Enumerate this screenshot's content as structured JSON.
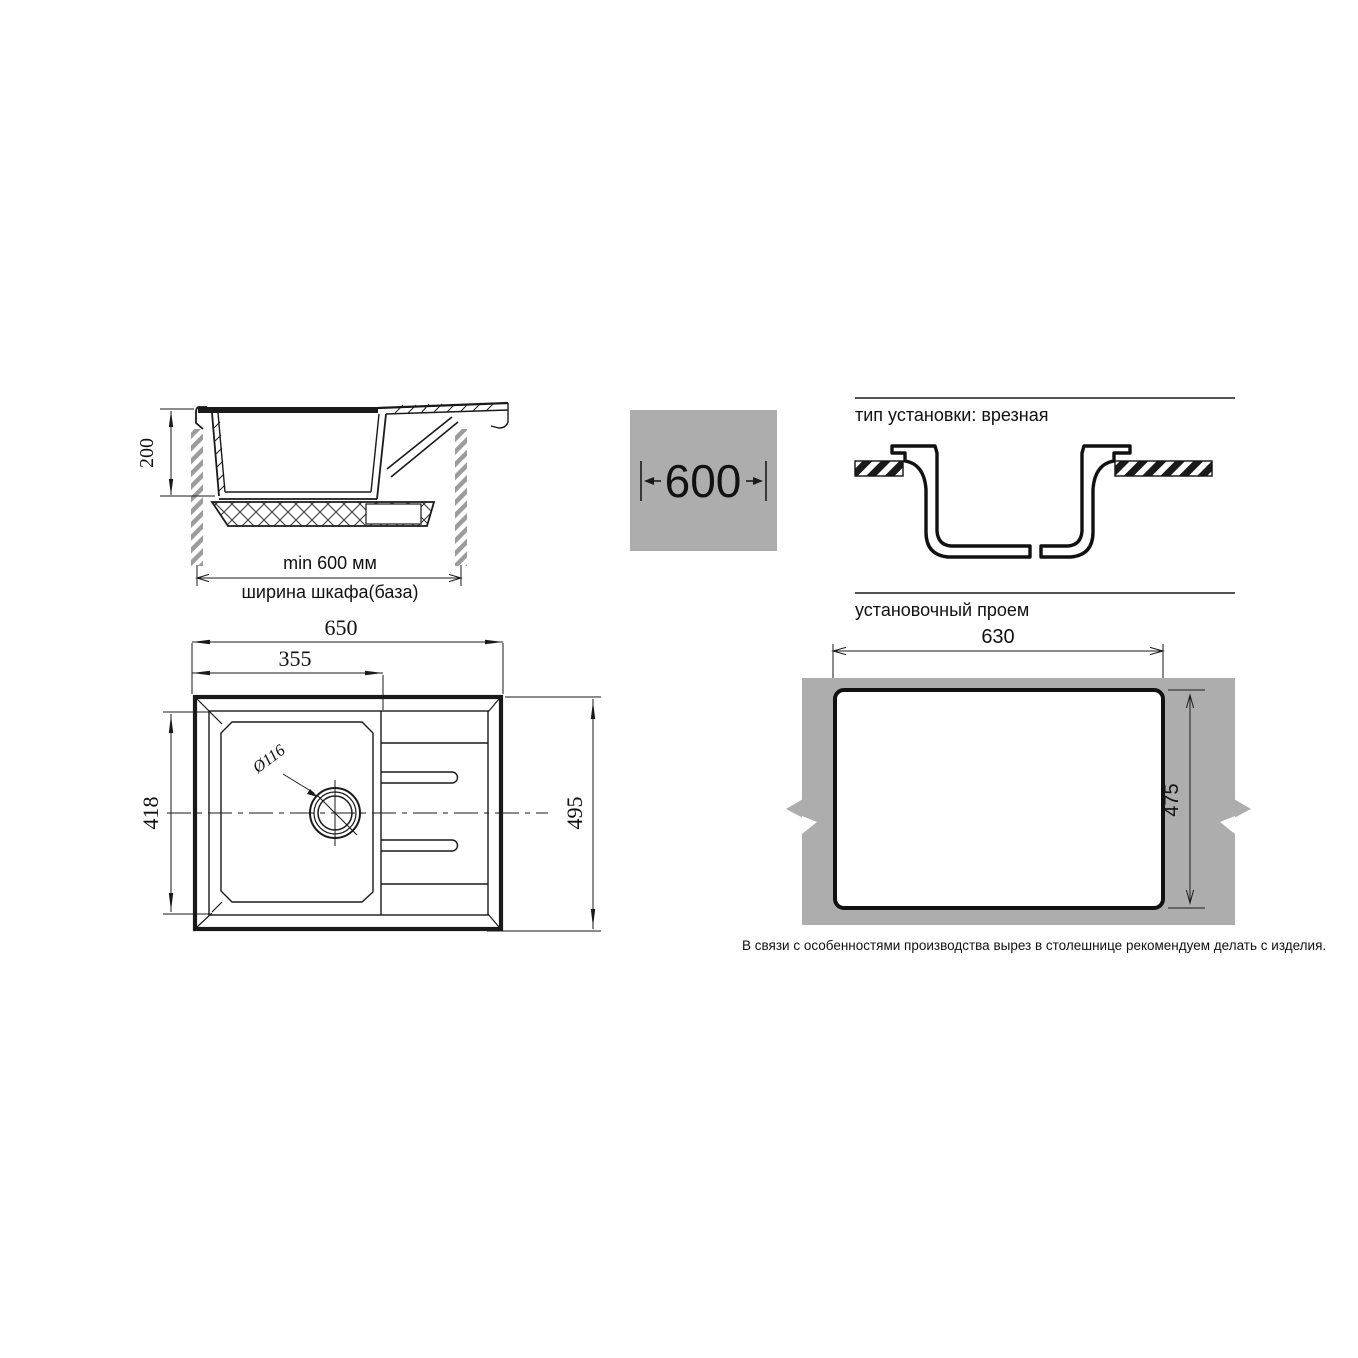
{
  "side_view": {
    "depth": "200",
    "min_width": "min 600 мм",
    "cabinet_width": "ширина шкафа(база)"
  },
  "badge": {
    "width": "600"
  },
  "installation": {
    "title": "тип установки: врезная"
  },
  "top_view": {
    "overall_width": "650",
    "bowl_width": "355",
    "bowl_depth": "418",
    "overall_depth": "495",
    "drain_diameter": "Ø116"
  },
  "cutout": {
    "title": "установочный проем",
    "width": "630",
    "height": "475",
    "note": "В связи с особенностями производства вырез в столешнице рекомендуем делать с изделия."
  },
  "colors": {
    "countertop_gray": "#adadad",
    "stripe_gray": "#9c9c9c",
    "line": "#1a1a1a"
  }
}
